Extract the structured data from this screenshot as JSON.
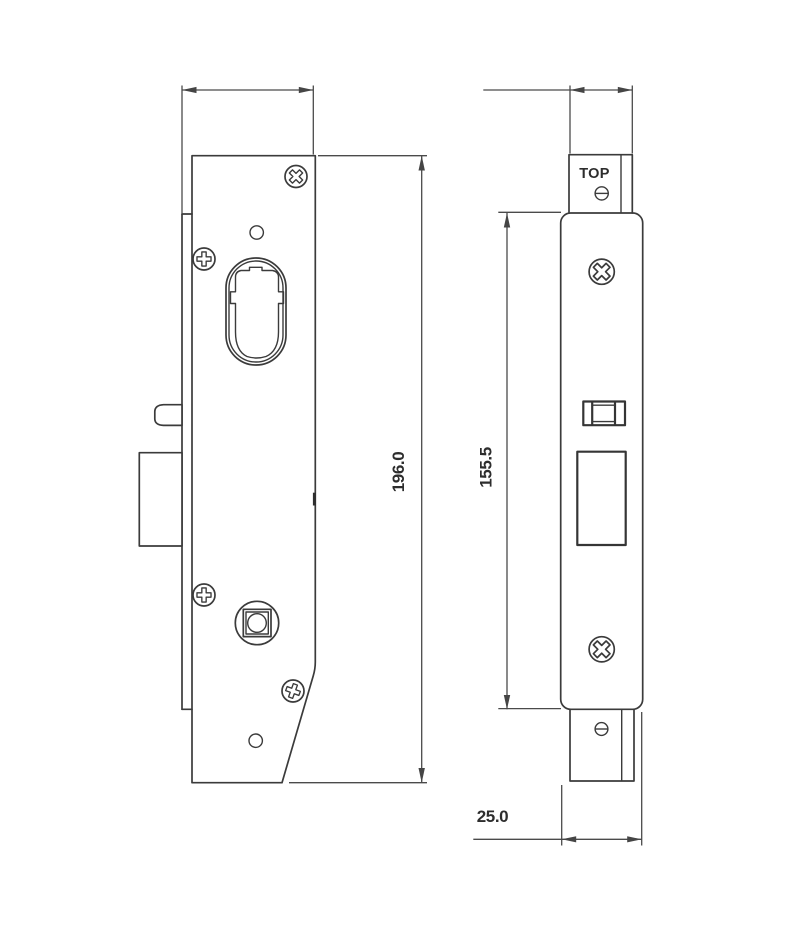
{
  "colors": {
    "background": "#ffffff",
    "part_line": "#3b3b3b",
    "dimension_line": "#4a4a4a",
    "text": "#2d2d2d"
  },
  "side_view": {
    "height_dim": "196.0"
  },
  "front_view": {
    "orientation_marking": "TOP",
    "height_dim": "155.5",
    "width_dim": "25.0"
  }
}
